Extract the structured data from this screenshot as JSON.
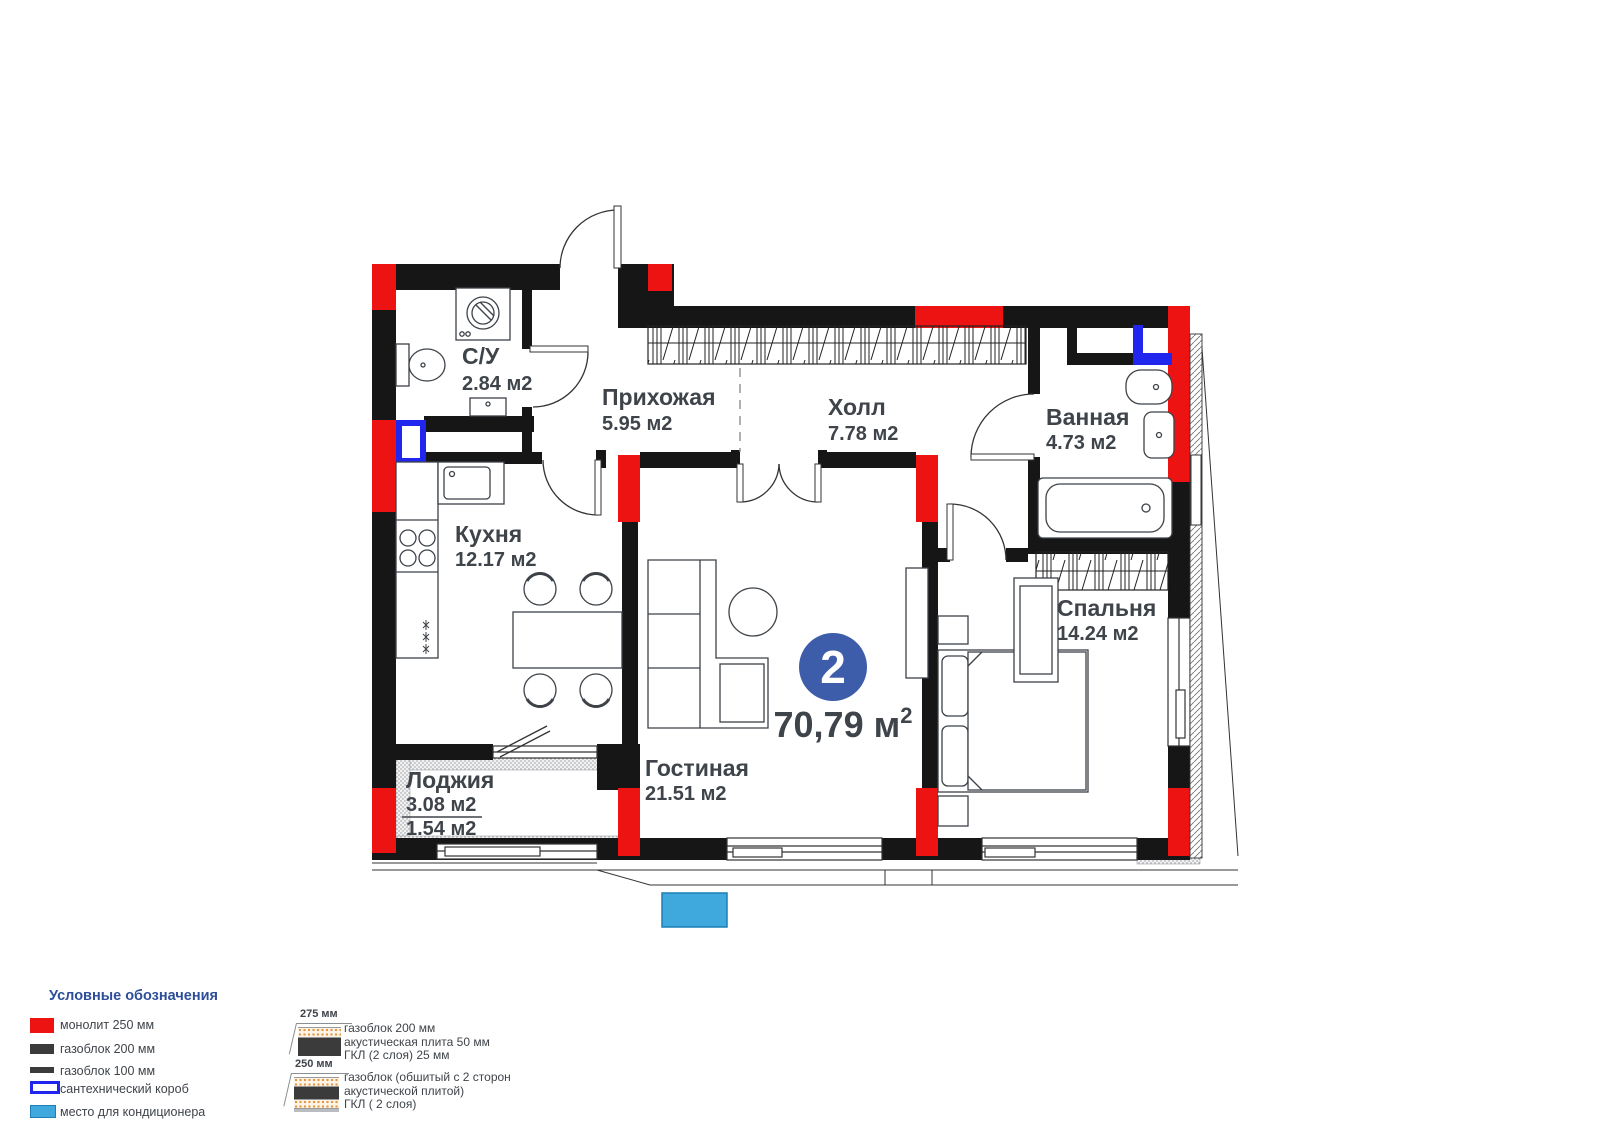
{
  "plan": {
    "badge": {
      "number": "2",
      "area": "70,79 м",
      "sup": "2"
    },
    "rooms": {
      "su": {
        "name": "С/У",
        "area": "2.84 м2"
      },
      "hallway": {
        "name": "Прихожая",
        "area": "5.95 м2"
      },
      "hall": {
        "name": "Холл",
        "area": "7.78 м2"
      },
      "bathroom": {
        "name": "Ванная",
        "area": "4.73 м2"
      },
      "kitchen": {
        "name": "Кухня",
        "area": "12.17 м2"
      },
      "bedroom": {
        "name": "Спальня",
        "area": "14.24 м2"
      },
      "living": {
        "name": "Гостиная",
        "area": "21.51 м2"
      },
      "loggia": {
        "name": "Лоджия",
        "area_full": "3.08 м2",
        "area_half": "1.54 м2"
      }
    }
  },
  "legend": {
    "title": "Условные обозначения",
    "items": [
      {
        "key": "monolith",
        "label": "монолит 250 мм",
        "color": "#ee1313"
      },
      {
        "key": "gasblock200",
        "label": "газоблок 200 мм",
        "color": "#3b3b3b"
      },
      {
        "key": "gasblock100",
        "label": "газоблок 100 мм",
        "color": "#3b3b3b"
      },
      {
        "key": "sanitary-box",
        "label": "сантехнический короб",
        "color": "#2126ee"
      },
      {
        "key": "ac-place",
        "label": "место для кондиционера",
        "color": "#3fa8dd"
      }
    ]
  },
  "wall_types": [
    {
      "size": "275 мм",
      "line1": "газоблок 200 мм",
      "line2": "акустическая плита 50 мм",
      "line3": "ГКЛ (2 слоя) 25 мм"
    },
    {
      "size": "250 мм",
      "line1": "газоблок (обшитый с 2 сторон",
      "line2": "акустической плитой)",
      "line3": "ГКЛ ( 2 слоя)"
    }
  ],
  "colors": {
    "wall": "#161616",
    "monolith_red": "#ee1313",
    "sanitary_blue": "#2126ee",
    "ac_blue": "#3fa8dd",
    "badge_blue": "#3d5caa",
    "legend_heading": "#2d4e99",
    "label_text": "#3f444a"
  }
}
